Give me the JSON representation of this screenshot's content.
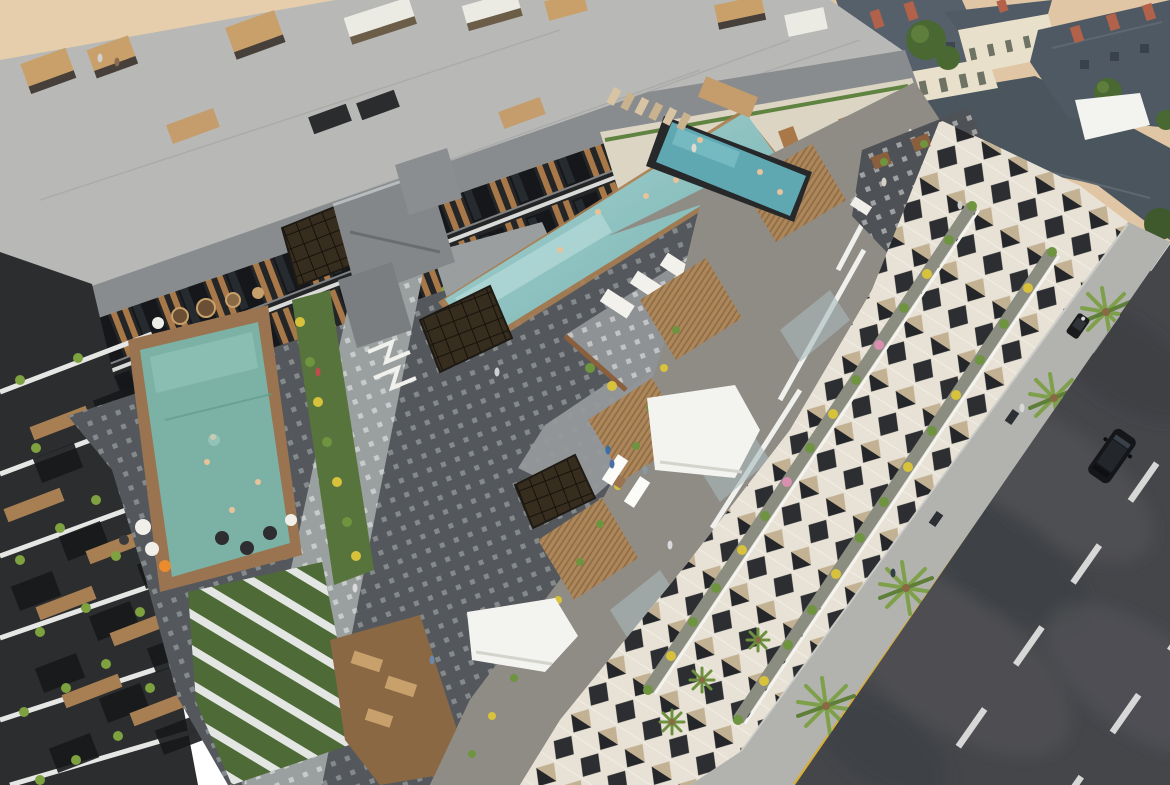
{
  "scene": {
    "type": "aerial-3d-architectural-render",
    "subject": "modern residential complex with courtyard pools, rooftop terraces, chevron-patterned balconies, beach promenade with cabanas, palm-lined sidewalk and multi-lane road",
    "inventory": {
      "pools": [
        "courtyard-pool",
        "central-lap-pool",
        "rooftop-pool"
      ],
      "cabana_count": 8,
      "canopy_count": 6,
      "palm_count": 14,
      "road_lanes": 3,
      "vehicles": [
        "suv",
        "utility-cart"
      ],
      "historic_buildings": "slate-roof district top-right",
      "beach": "sand area top-left"
    }
  },
  "palette": {
    "sand": "#e0c6a4",
    "sandLight": "#ead4b2",
    "promenade": "#b8b9b7",
    "cabanaWood": "#c9a06a",
    "cabanaRoof": "#ecebe3",
    "roofConcrete": "#898c8e",
    "northFacadeBase": "#232527",
    "creamWall": "#ddd5c4",
    "parisWall": "#e8e0ca",
    "slate": "#4e5964",
    "slateDark": "#4a555e",
    "chimney": "#b2614a",
    "treeGreen": "#4a6831",
    "leftBuilding": "#2b2d2f",
    "slabWhite": "#eceded",
    "wood": "#a87f52",
    "woodDark": "#8a6a44",
    "courtyardPaving": "#54585c",
    "pavingLight": "#9aa0a0",
    "lawn": "#57743c",
    "lawnDark": "#4e6a36",
    "poolLeft": "#7cb2a6",
    "poolCentralTop": "#a6d3d4",
    "poolCentralBottom": "#76b1ad",
    "poolRooftop": "#5fa8b2",
    "deckWood": "#9a7450",
    "eastBand": "#8f8b85",
    "glassBalcony": "#a9babd",
    "canopyWhite": "#f3f3ef",
    "chevronBg": "#e8e2d6",
    "chevronDark": "#2c2e31",
    "chevronTan": "#c3b193",
    "planterGreen": "#6f9440",
    "flowerYellow": "#d8c23c",
    "flowerPink": "#d88fb0",
    "sidewalk": "#b2b3af",
    "curbYellow": "#d7ae3a",
    "road": "#45464a",
    "laneMark": "#e3e4e2",
    "carBody": "#141619",
    "skin": "#e8c39a"
  }
}
